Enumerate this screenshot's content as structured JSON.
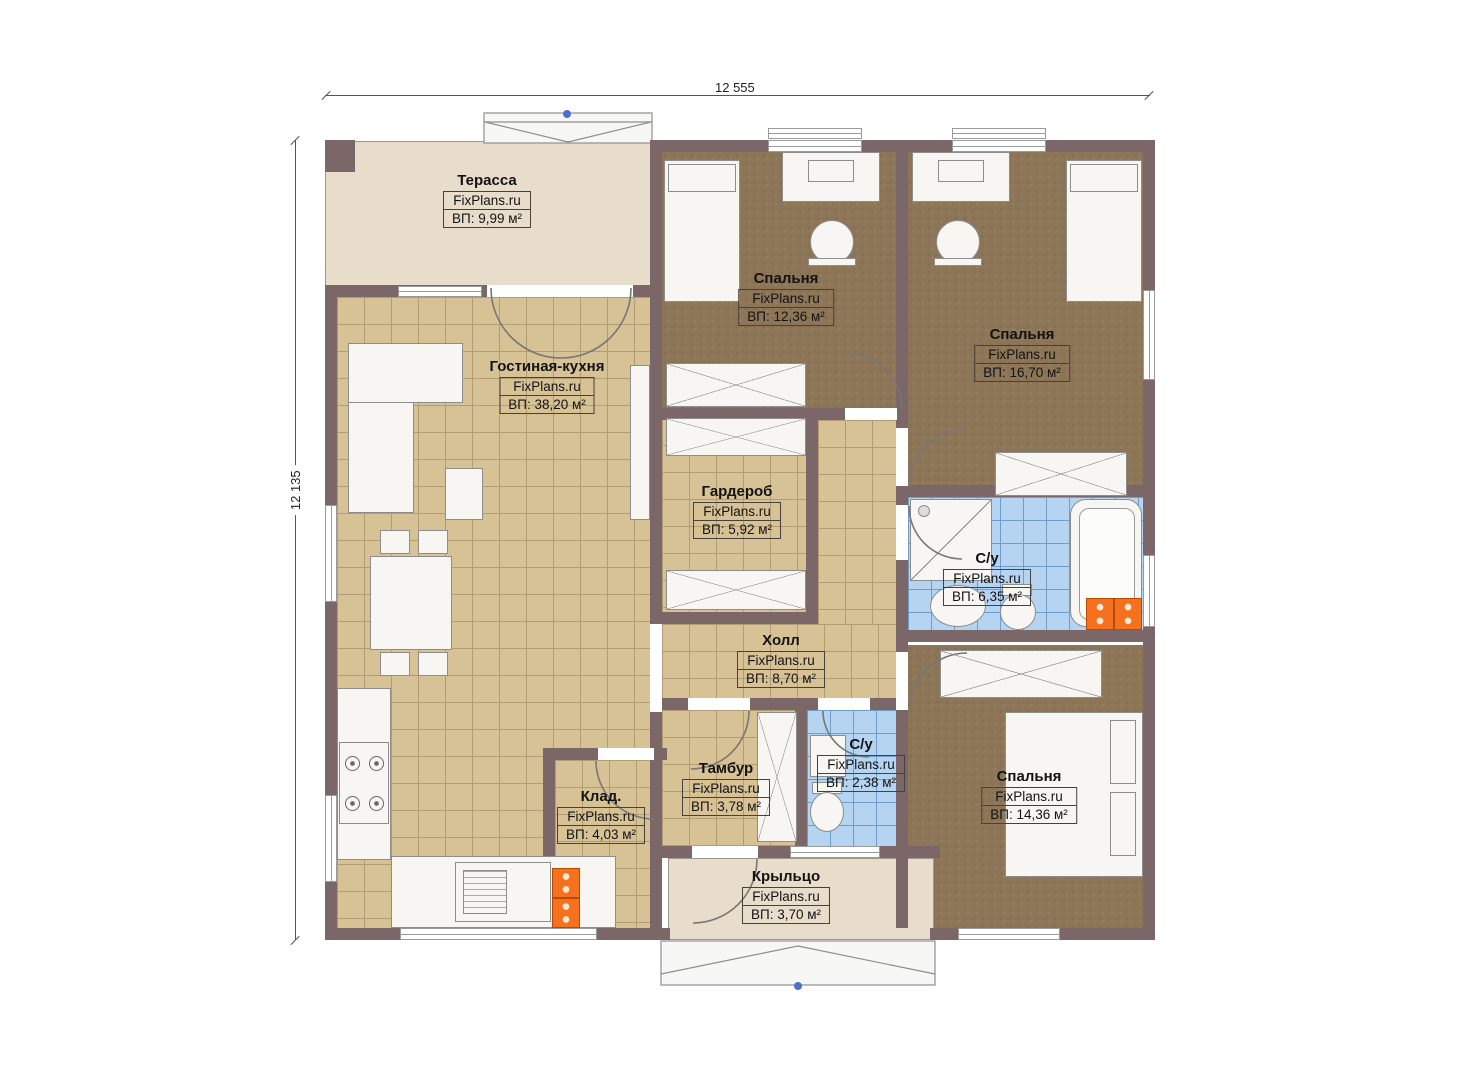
{
  "brand": "FixPlans.ru",
  "dimensions": {
    "top": "12 555",
    "left": "12 135"
  },
  "rooms": [
    {
      "name": "Терасса",
      "area": "ВП: 9,99 м²"
    },
    {
      "name": "Гостиная-кухня",
      "area": "ВП: 38,20 м²"
    },
    {
      "name": "Спальня",
      "area": "ВП: 12,36 м²"
    },
    {
      "name": "Спальня",
      "area": "ВП: 16,70 м²"
    },
    {
      "name": "Гардероб",
      "area": "ВП: 5,92 м²"
    },
    {
      "name": "С/у",
      "area": "ВП: 6,35 м²"
    },
    {
      "name": "Холл",
      "area": "ВП: 8,70 м²"
    },
    {
      "name": "Тамбур",
      "area": "ВП: 3,78 м²"
    },
    {
      "name": "Клад.",
      "area": "ВП: 4,03 м²"
    },
    {
      "name": "С/у",
      "area": "ВП: 2,38 м²"
    },
    {
      "name": "Спальня",
      "area": "ВП: 14,36 м²"
    },
    {
      "name": "Крыльцо",
      "area": "ВП: 3,70 м²"
    }
  ],
  "palette": {
    "wall": "#7b6768",
    "tile_floor": "#d7c296",
    "carpet_floor": "#8d7557",
    "bath_tile": "#b5d4f1",
    "terrace_floor": "#e8dcca",
    "radiator": "#f5711d",
    "marker_blue": "#4a6fd0"
  }
}
